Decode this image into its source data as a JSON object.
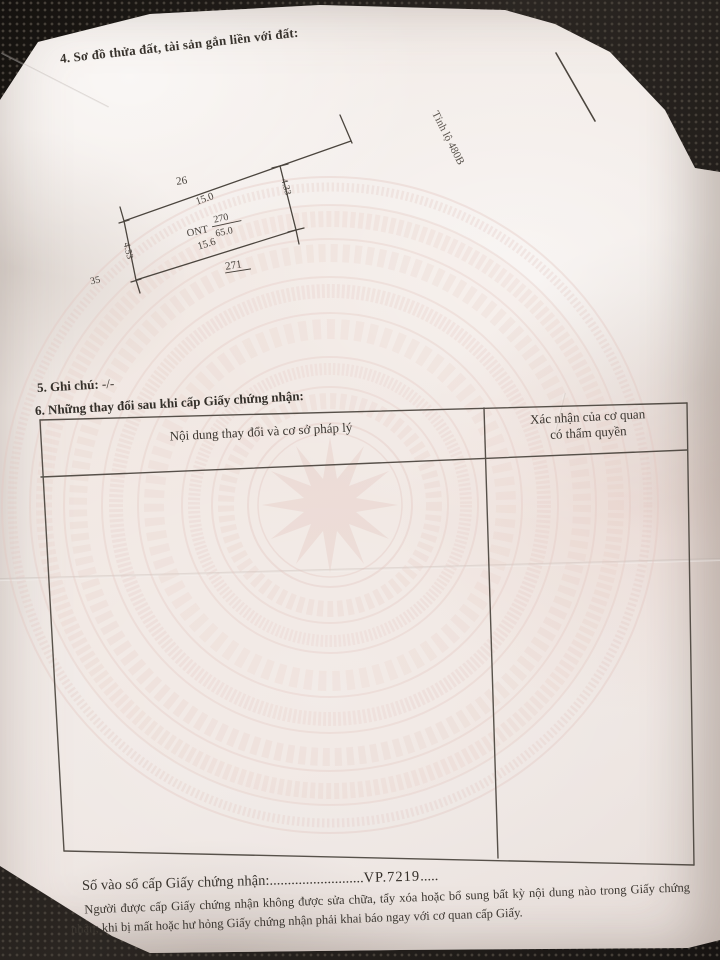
{
  "page": {
    "section4_heading": "4. Sơ đồ thửa đất, tài sản gắn liền với đất:",
    "section5_label": "5. Ghi chú:",
    "section5_value": "-/-",
    "section6_heading": "6. Những thay đổi sau khi cấp Giấy chứng nhận:",
    "table": {
      "col1_header": "Nội dung thay đổi và cơ sở pháp lý",
      "col2_header_line1": "Xác nhận của cơ quan",
      "col2_header_line2": "có thẩm quyền"
    },
    "footer": {
      "entry_label": "Số vào sổ cấp Giấy chứng nhận:",
      "leader_dots": "..........................",
      "entry_number": "VP.7219",
      "trailing_dots": ".....",
      "note_text": "Người được cấp Giấy chứng nhận không được sửa chữa, tẩy xóa hoặc bổ sung bất kỳ nội dung nào trong Giấy chứng nhận; khi bị mất hoặc hư hỏng Giấy chứng nhận phải khai báo ngay với cơ quan cấp Giấy."
    }
  },
  "diagram": {
    "adjacent_parcel_top": "26",
    "top_edge_length": "15.0",
    "land_use_code": "ONT",
    "plot_number": "270",
    "plot_area": "65.0",
    "bottom_edge_length": "15.6",
    "adjacent_parcel_bottom": "271",
    "left_edge_length": "4.53",
    "right_edge_length": "4.33",
    "adjacent_parcel_left": "35",
    "road_label": "Tỉnh lộ 480B"
  },
  "colors": {
    "ink": "#46403a",
    "paper": "#f1eae6",
    "watermark_pink": "#e3c6bf",
    "background_dark": "#221e1b"
  }
}
